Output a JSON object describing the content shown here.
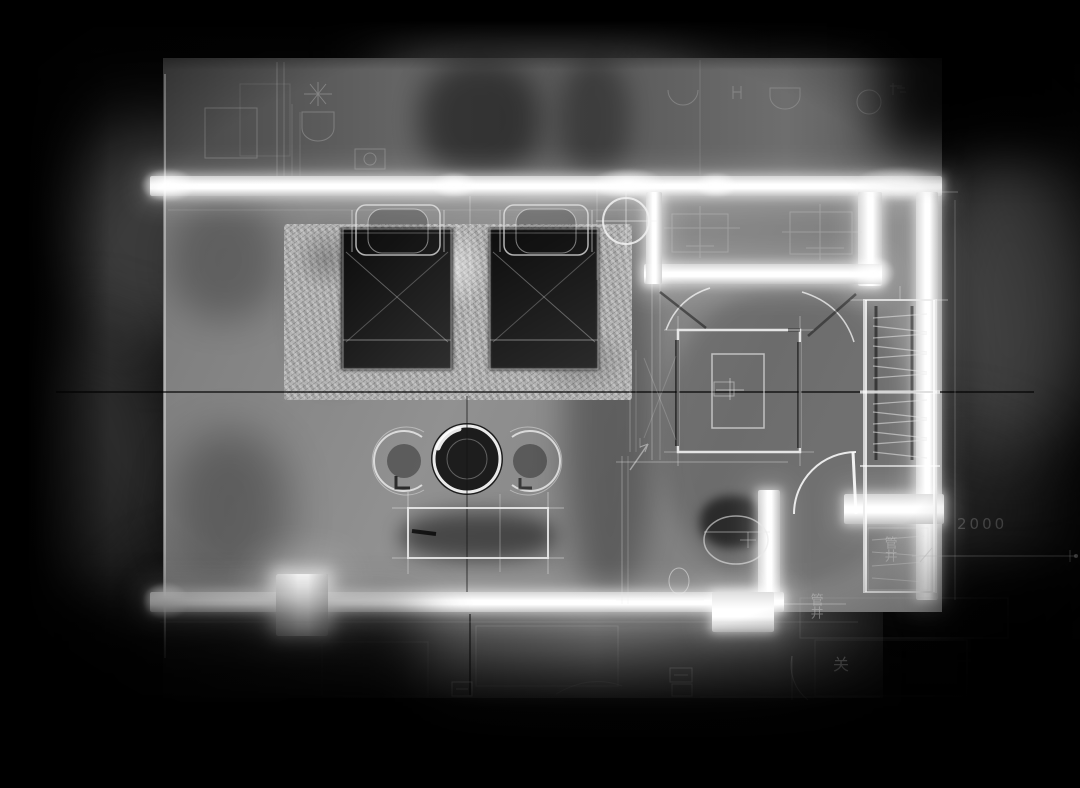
{
  "meta": {
    "type": "architectural floor plan",
    "style": "inverted light-on-dark blueprint render",
    "subject": "twin-bed hotel guestroom with bathroom, entry corridor and wardrobe"
  },
  "colors": {
    "background": "#040404",
    "floor_gray": "#8a8a8a",
    "upper_floor_gray": "#5c5c5c",
    "wall_white": "#ffffff",
    "rug_gray": "#b3b3b3",
    "linework": "#e6e6e6",
    "dark_furniture": "#101010"
  },
  "labels": {
    "dimension": "2000",
    "shaft_upper": "管井",
    "shaft_lower": "管井",
    "door_mark": "关"
  },
  "rooms": [
    {
      "name": "sleeping-area"
    },
    {
      "name": "sitting-area"
    },
    {
      "name": "bathroom"
    },
    {
      "name": "entry-corridor"
    },
    {
      "name": "wardrobe-niche"
    },
    {
      "name": "pipe-shaft"
    }
  ],
  "furniture": [
    "twin-bed-left",
    "twin-bed-right",
    "pillow-left",
    "pillow-right",
    "area-rug",
    "round-tea-table",
    "lounge-chair-left",
    "lounge-chair-right",
    "tv-cabinet",
    "shower-enclosure",
    "toilet",
    "floor-drain",
    "wardrobe-hanging-rails",
    "entry-door-swing",
    "bathroom-door-swings",
    "structural-column",
    "column-crosshair-symbol"
  ]
}
